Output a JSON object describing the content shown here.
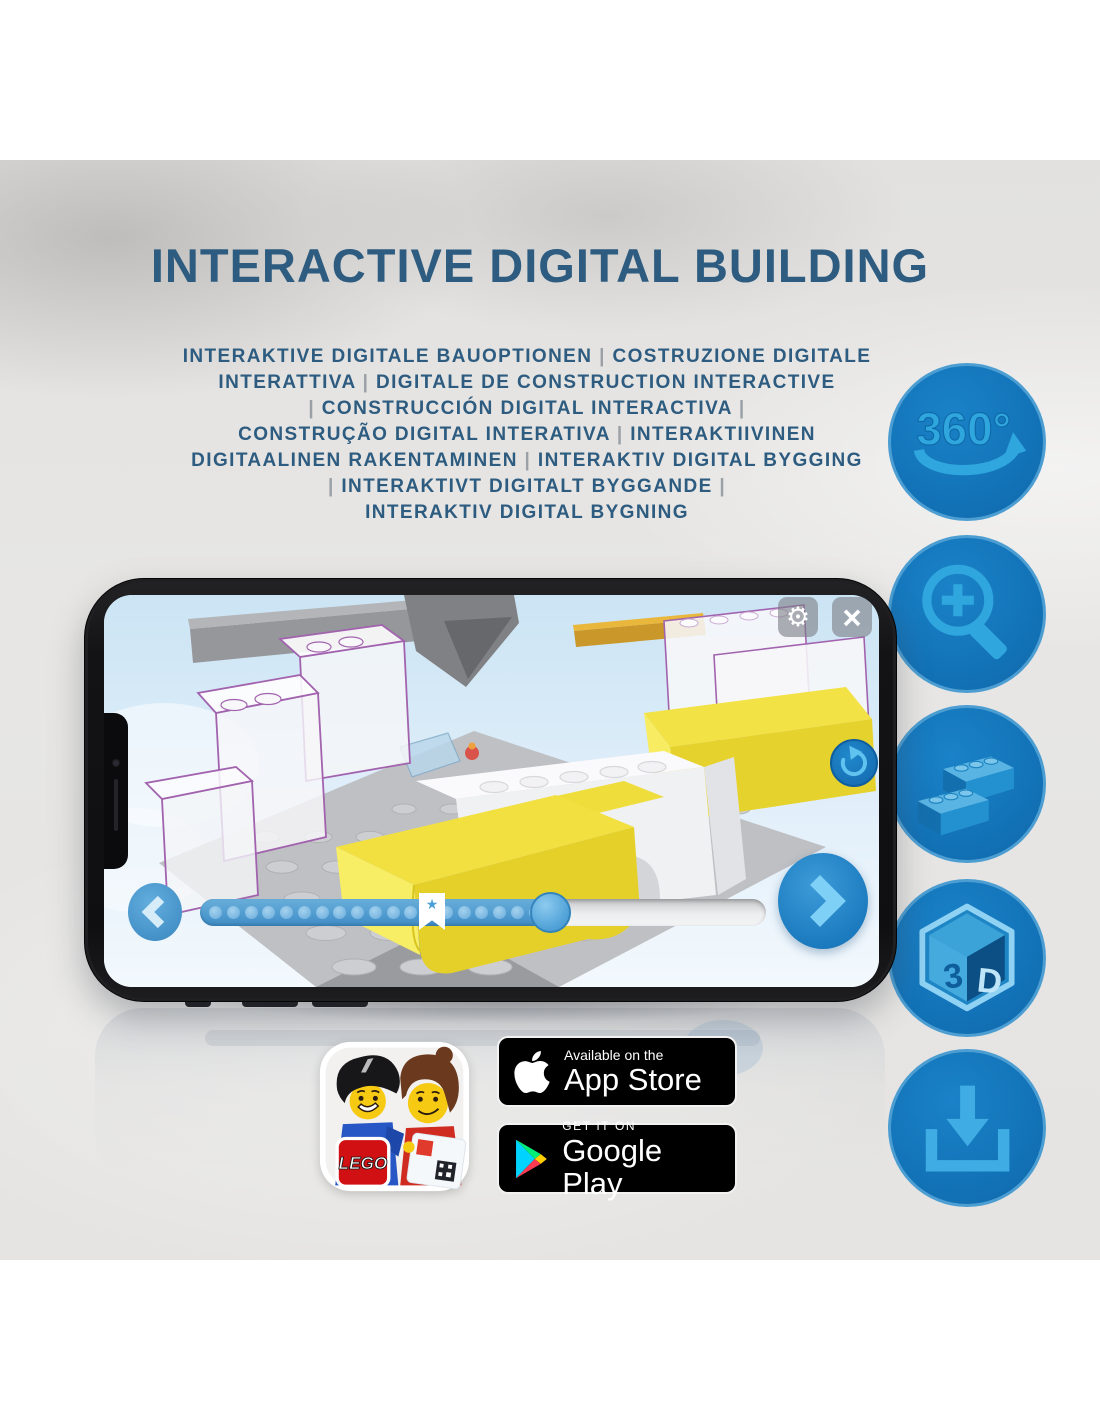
{
  "title": "INTERACTIVE DIGITAL BUILDING",
  "subtitle_lines": [
    "INTERAKTIVE DIGITALE BAUOPTIONEN | COSTRUZIONE DIGITALE",
    "INTERATTIVA | DIGITALE DE CONSTRUCTION INTERACTIVE",
    "| CONSTRUCCIÓN DIGITAL INTERACTIVA |",
    "CONSTRUÇÃO DIGITAL INTERATIVA | INTERAKTIIVINEN",
    "DIGITAALINEN RAKENTAMINEN | INTERAKTIV DIGITAL BYGGING",
    "| INTERAKTIVT DIGITALT BYGGANDE |",
    "INTERAKTIV DIGITAL BYGNING"
  ],
  "feature_column": {
    "rotation_label": "360°",
    "cube_left": "3",
    "cube_right": "D"
  },
  "phone_app": {
    "progress": {
      "dot_count": 19,
      "filled_ratio": 0.62,
      "bookmark_ratio": 0.41
    },
    "icons": {
      "gear": "⚙",
      "close": "×",
      "star": "★"
    }
  },
  "badges": {
    "app_store": {
      "line1": "Available on the",
      "line2": "App Store"
    },
    "google_play": {
      "line1": "GET IT ON",
      "line2": "Google Play"
    },
    "lego": {
      "logo": "LEGO"
    }
  },
  "colors": {
    "heading_blue": "#2d5c80",
    "circle_blue": "#1373b8",
    "icon_light_blue": "#2fa6dd",
    "lego_red": "#d01012",
    "brick_yellow": "#f1e040"
  }
}
